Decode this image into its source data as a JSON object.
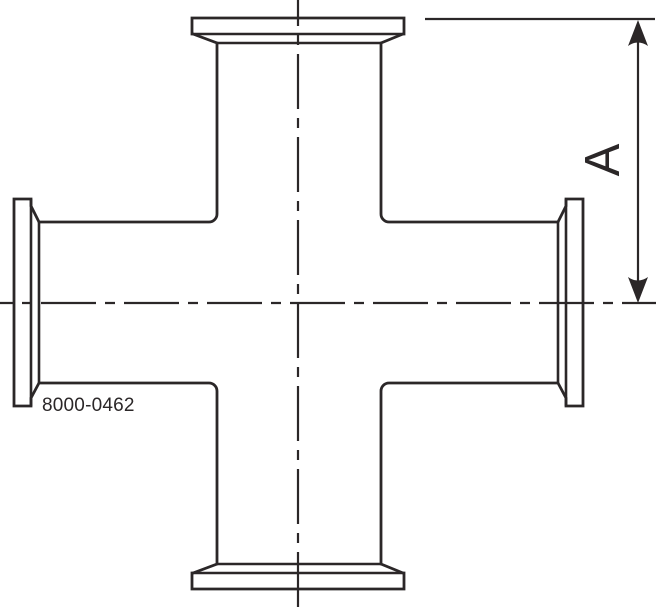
{
  "drawing": {
    "description": "Cross fitting with clamp ferrule ends, orthographic side view",
    "part_number": "8000-0462",
    "dimension": {
      "label": "A"
    },
    "colors": {
      "line": "#2b2728",
      "background": "#ffffff"
    }
  }
}
